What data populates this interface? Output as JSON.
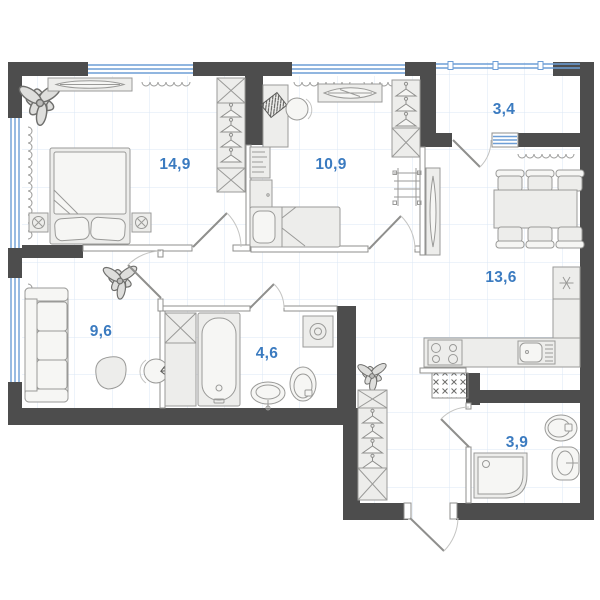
{
  "floor_plan": {
    "type": "apartment-floor-plan",
    "area_unit": "m2",
    "labels": {
      "bedroom": "14,9",
      "kids_room": "10,9",
      "balcony": "3,4",
      "kitchen_living": "13,6",
      "living_room": "9,6",
      "bathroom": "4,6",
      "shower_room": "3,9"
    },
    "rooms": [
      {
        "id": "bedroom",
        "area_label": "14,9",
        "furniture": [
          "double-bed",
          "nightstands",
          "wardrobe-hangers",
          "dresser",
          "plant",
          "radiators"
        ]
      },
      {
        "id": "kids-room",
        "area_label": "10,9",
        "furniture": [
          "single-bed",
          "desk",
          "office-chair",
          "bookshelf",
          "wardrobe-hangers",
          "wall-ladder",
          "decor-shelf",
          "radiators"
        ]
      },
      {
        "id": "balcony",
        "area_label": "3,4",
        "furniture": [
          "glazing"
        ]
      },
      {
        "id": "kitchen-living-room",
        "area_label": "13,6",
        "furniture": [
          "dining-table",
          "six-chairs",
          "fridge",
          "l-counter",
          "stove",
          "sink",
          "tall-mirror-cabinet",
          "vent-box",
          "radiator"
        ]
      },
      {
        "id": "living-room",
        "area_label": "9,6",
        "furniture": [
          "sofa",
          "pouf",
          "plant",
          "desk-chair",
          "laptop-desk",
          "radiators"
        ]
      },
      {
        "id": "bathroom",
        "area_label": "4,6",
        "furniture": [
          "bathtub",
          "cabinet",
          "washing-machine",
          "toilet",
          "sink"
        ]
      },
      {
        "id": "shower-room",
        "area_label": "3,9",
        "furniture": [
          "shower-tray",
          "toilet",
          "sink"
        ]
      },
      {
        "id": "hallway",
        "area_label": "",
        "furniture": [
          "wardrobe-hangers",
          "plant",
          "entrance-door"
        ]
      }
    ],
    "colors": {
      "wall": "#4d4d4d",
      "room_label": "#3b7bc0",
      "window_glass": "#6d9ed6",
      "grid": "#dbe7f4",
      "furniture_fill": "#ededeb",
      "furniture_stroke": "#9a9a98",
      "background": "#ffffff"
    }
  }
}
